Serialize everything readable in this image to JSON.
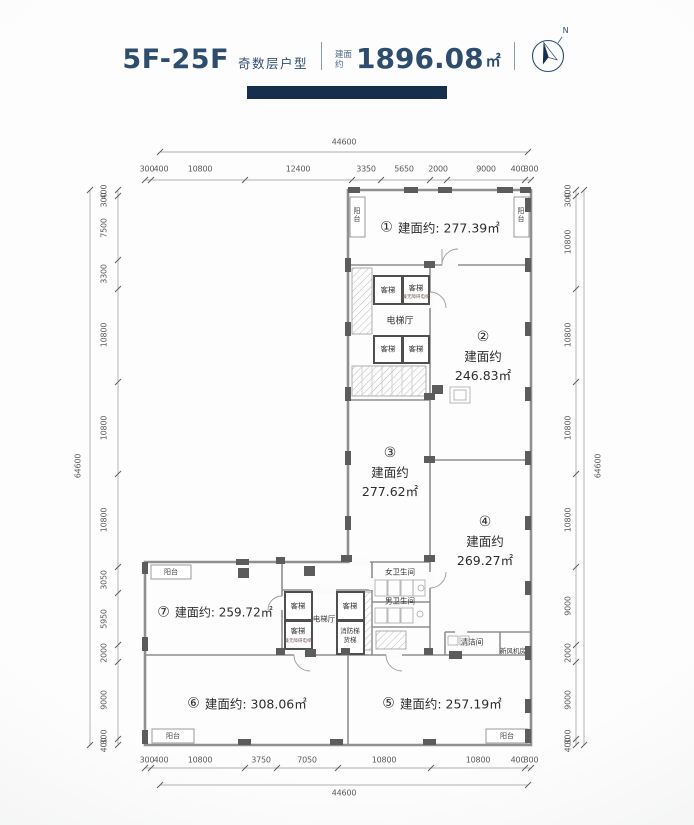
{
  "header": {
    "floor_range": "5F-25F",
    "floor_type": "奇数层户型",
    "area_label": "建面约",
    "area_value": "1896.08",
    "area_unit": "㎡",
    "compass_n": "N"
  },
  "units": {
    "u1": {
      "num": "①",
      "area": "建面约: 277.39㎡"
    },
    "u2": {
      "num": "②",
      "label": "建面约",
      "value": "246.83㎡"
    },
    "u3": {
      "num": "③",
      "label": "建面约",
      "value": "277.62㎡"
    },
    "u4": {
      "num": "④",
      "label": "建面约",
      "value": "269.27㎡"
    },
    "u5": {
      "num": "⑤",
      "area": "建面约: 257.19㎡"
    },
    "u6": {
      "num": "⑥",
      "area": "建面约: 308.06㎡"
    },
    "u7": {
      "num": "⑦",
      "area": "建面约: 259.72㎡"
    }
  },
  "rooms": {
    "passenger_elevator": "客梯",
    "elevator_hall": "电梯厅",
    "accessible_elevator_note": "兼无障碍电梯",
    "fire_stair": "消防梯",
    "freight_elevator": "货梯",
    "womens_restroom": "女卫生间",
    "mens_restroom": "男卫生间",
    "cleaning_room": "清洁间",
    "fresh_air_room": "新风机房",
    "balcony": "阳台"
  },
  "dims": {
    "top": {
      "total": "44600",
      "segments": [
        "300",
        "400",
        "10800",
        "12400",
        "3350",
        "5650",
        "2000",
        "9000",
        "400",
        "300"
      ]
    },
    "bottom": {
      "total": "44600",
      "segments": [
        "300",
        "400",
        "10800",
        "3750",
        "7050",
        "10800",
        "10800",
        "400",
        "300"
      ]
    },
    "left": {
      "total": "64600",
      "segments": [
        "400",
        "300",
        "7500",
        "3300",
        "10800",
        "10800",
        "10800",
        "3050",
        "5950",
        "2000",
        "9000",
        "300",
        "400"
      ]
    },
    "right": {
      "total": "64600",
      "segments": [
        "400",
        "300",
        "10800",
        "10800",
        "10800",
        "10800",
        "9000",
        "2000",
        "9000",
        "300",
        "400"
      ]
    }
  },
  "colors": {
    "accent": "#2e4d6e",
    "bar": "#152f4c",
    "wall": "#8f8f8f",
    "column": "#5c5c5c"
  }
}
